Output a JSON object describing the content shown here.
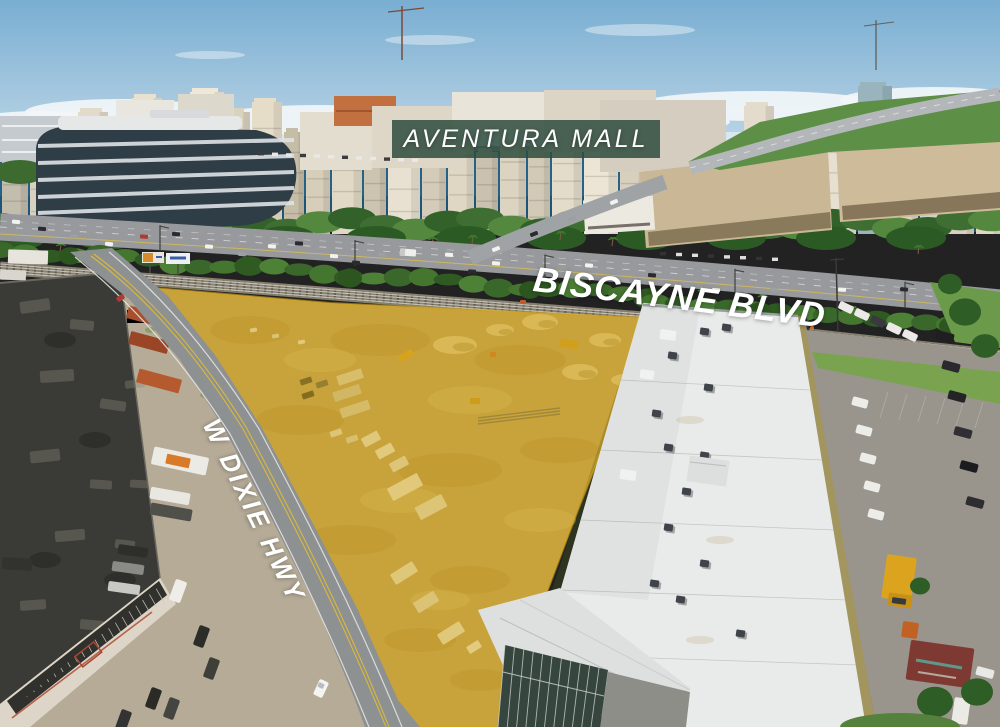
{
  "scene": {
    "description": "Aerial drone photo of a triangular development parcel highlighted in gold, bordered by W Dixie Hwy and Biscayne Blvd, with Aventura Mall and an oceanfront high-rise skyline in the background"
  },
  "labels": {
    "mall_banner": "AVENTURA MALL",
    "road_top": "BISCAYNE BLVD",
    "road_left": "W DIXIE HWY"
  },
  "colors": {
    "banner_bg": "#2f4c3d",
    "label_text": "#ffffff",
    "parcel_highlight": "#d2a416",
    "sky": "#85b5d5",
    "ocean": "#266287",
    "vegetation": "#3d6b2a",
    "warehouse_roof": "#e9ebea",
    "asphalt": "#97999c",
    "dark_roof": "#3a3a36"
  }
}
